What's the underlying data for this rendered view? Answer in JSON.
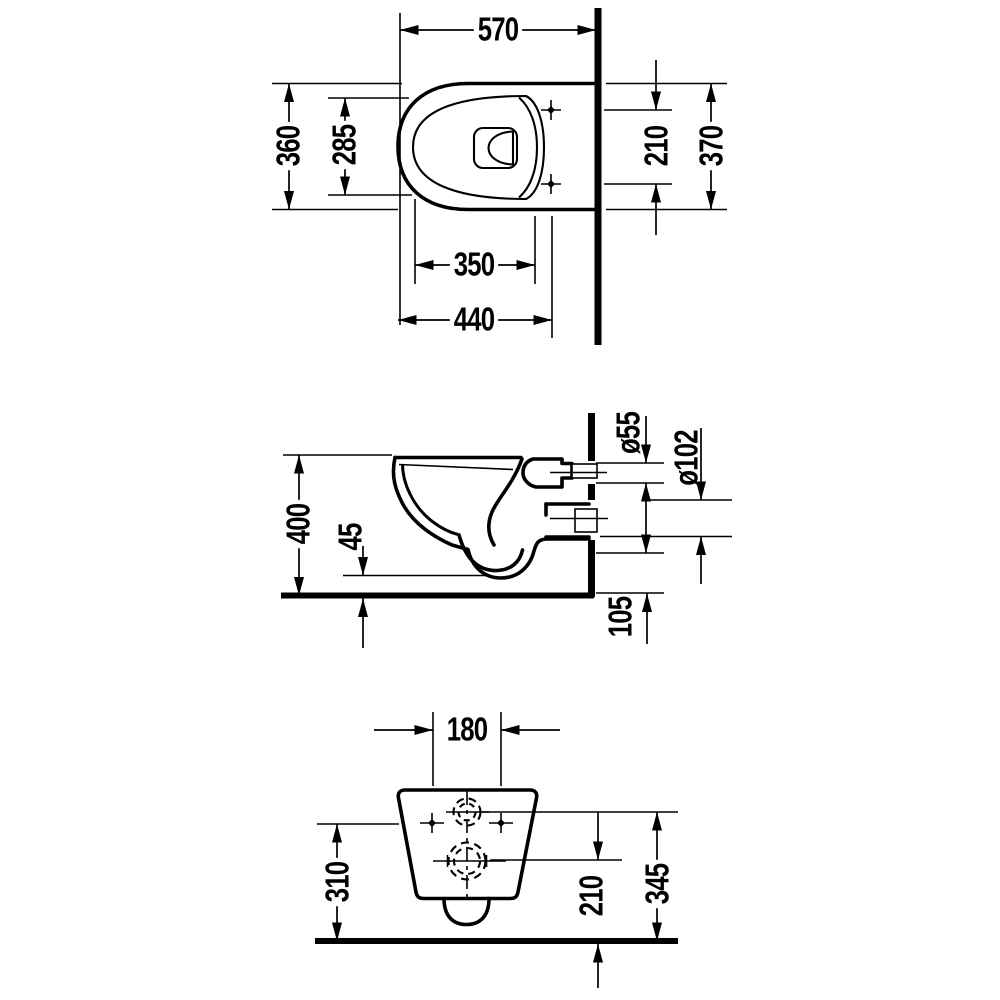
{
  "colors": {
    "line": "#000000",
    "background": "#ffffff"
  },
  "views": {
    "plan": {
      "dims": {
        "overall_depth": "570",
        "outer_width": "360",
        "inner_width": "285",
        "bowl_inner_length": "350",
        "seat_length": "440",
        "fixing_spacing": "210",
        "back_depth": "370"
      }
    },
    "side": {
      "dims": {
        "height": "400",
        "clearance": "45",
        "flush_pipe_diameter": "ø55",
        "outlet_diameter": "ø102",
        "outlet_bottom_height": "105"
      }
    },
    "rear": {
      "dims": {
        "connection_spacing": "180",
        "side_height": "310",
        "outlet_centre_height": "210",
        "flush_centre_height": "345"
      }
    }
  }
}
